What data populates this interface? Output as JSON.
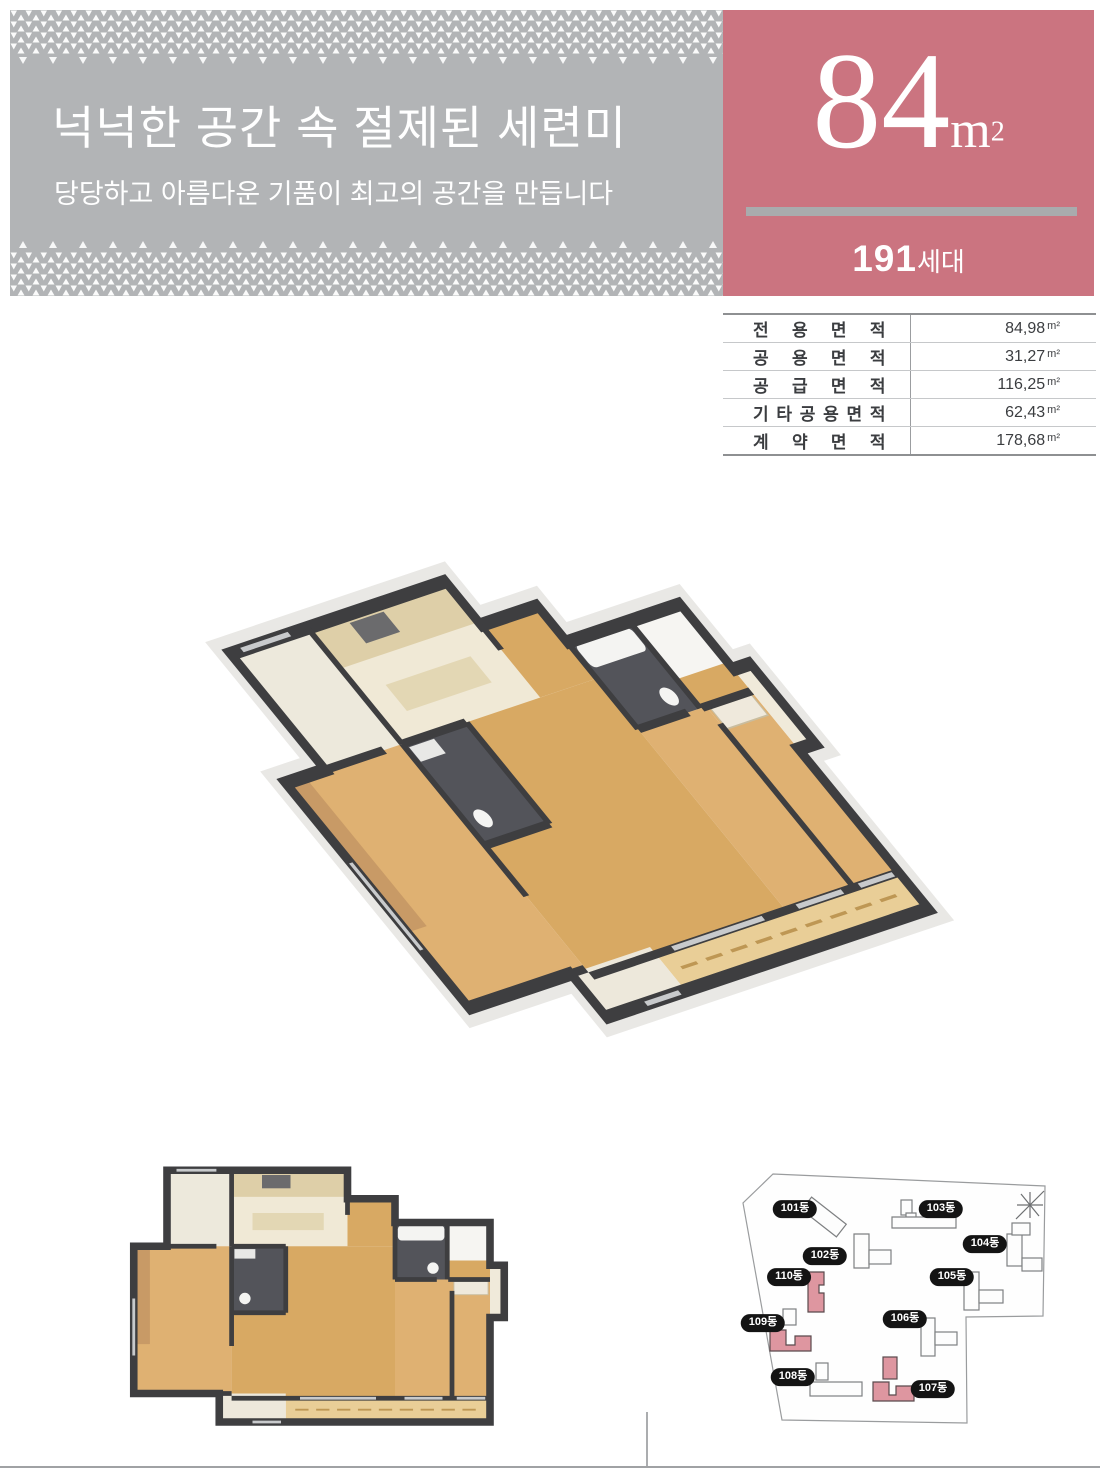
{
  "header": {
    "title": "넉넉한 공간 속 절제된 세련미",
    "subtitle": "당당하고 아름다운 기품이 최고의 공간을 만듭니다"
  },
  "unit_badge": {
    "area_number": "84",
    "area_unit": "m",
    "area_exponent": "2",
    "households_number": "191",
    "households_unit": "세대"
  },
  "area_table": {
    "rows": [
      {
        "label": "전 용 면 적",
        "value": "84,98",
        "unit": "m²"
      },
      {
        "label": "공 용 면 적",
        "value": "31,27",
        "unit": "m²"
      },
      {
        "label": "공 급 면 적",
        "value": "116,25",
        "unit": "m²"
      },
      {
        "label": "기 타 공 용 면 적",
        "value": "62,43",
        "unit": "m²"
      },
      {
        "label": "계 약 면 적",
        "value": "178,68",
        "unit": "m²"
      }
    ]
  },
  "site_plan": {
    "buildings": [
      {
        "label": "101동",
        "highlighted": false
      },
      {
        "label": "102동",
        "highlighted": false
      },
      {
        "label": "103동",
        "highlighted": false
      },
      {
        "label": "104동",
        "highlighted": false
      },
      {
        "label": "105동",
        "highlighted": false
      },
      {
        "label": "106동",
        "highlighted": false
      },
      {
        "label": "107동",
        "highlighted": true
      },
      {
        "label": "108동",
        "highlighted": false
      },
      {
        "label": "109동",
        "highlighted": true
      },
      {
        "label": "110동",
        "highlighted": true
      }
    ]
  },
  "colors": {
    "banner_gray": "#B2B4B6",
    "accent_pink": "#CB7480",
    "building_highlight_pink": "#DE96A0",
    "wall_dark": "#3E3E40",
    "wood_floor": "#D8A963"
  }
}
